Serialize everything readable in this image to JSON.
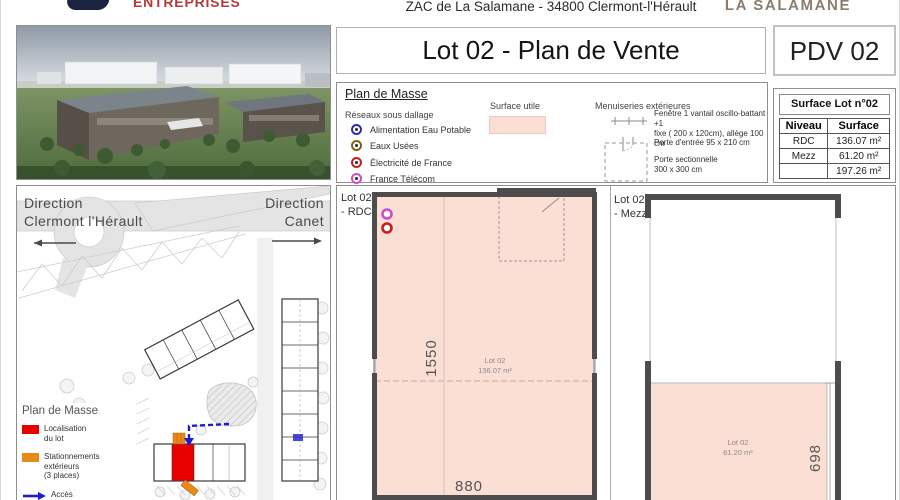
{
  "header": {
    "logo_text": "ENTREPRISES",
    "address": "ZAC de La Salamane - 34800 Clermont-l'Hérault",
    "brand": "LA SALAMANE"
  },
  "title": {
    "main": "Lot 02 - Plan de Vente",
    "ref": "PDV 02"
  },
  "legend": {
    "heading": "Plan de Masse",
    "networks": {
      "heading": "Réseaux sous dallage",
      "items": [
        {
          "label": "Alimentation Eau Potable",
          "color": "#2a2ab8"
        },
        {
          "label": "Eaux Usées",
          "color": "#7a6414"
        },
        {
          "label": "Électricité de France",
          "color": "#c81e1e"
        },
        {
          "label": "France Télécom",
          "color": "#cc4ccc"
        }
      ]
    },
    "surface": {
      "heading": "Surface utile",
      "color": "#fbdfd5"
    },
    "joinery": {
      "heading": "Menuiseries extérieures",
      "items": [
        "Fenêtre 1 vantail oscillo-battant +1\nfixe ( 200 x 120cm), allège 100 cm",
        "Porte d'entrée 95 x 210 cm",
        "Porte sectionnelle\n300 x 300 cm"
      ]
    }
  },
  "surface_table": {
    "title": "Surface Lot n°02",
    "columns": [
      "Niveau",
      "Surface"
    ],
    "rows": [
      [
        "RDC",
        "136.07 m²"
      ],
      [
        "Mezz",
        "61.20 m²"
      ],
      [
        "",
        "197.26 m²"
      ]
    ]
  },
  "site_plan": {
    "direction_left": "Direction\nClermont l'Hérault",
    "direction_right": "Direction\nCanet",
    "legend_heading": "Plan de Masse",
    "legend_items": [
      {
        "label": "Localisation\ndu lot",
        "color": "#e60000"
      },
      {
        "label": "Stationnements\nextérieurs\n(3 places)",
        "color": "#e8891c"
      },
      {
        "label": "Accès\nVéhicules",
        "color": "#1d1dcd"
      }
    ]
  },
  "plans": {
    "rdc": {
      "label": "Lot 02\n- RDC",
      "lot": "Lot 02",
      "area": "136.07 m²",
      "dim_height": "1550",
      "dim_width": "880"
    },
    "mezz": {
      "label": "Lot 02\n- Mezz",
      "lot": "Lot 02",
      "area": "61.20 m²",
      "dim_height": "698"
    }
  },
  "colors": {
    "logo_navy": "#1d2442",
    "logo_red": "#b43a3a",
    "brand_taupe": "#8b7c6c",
    "wall_gray": "#4d4d4d"
  }
}
